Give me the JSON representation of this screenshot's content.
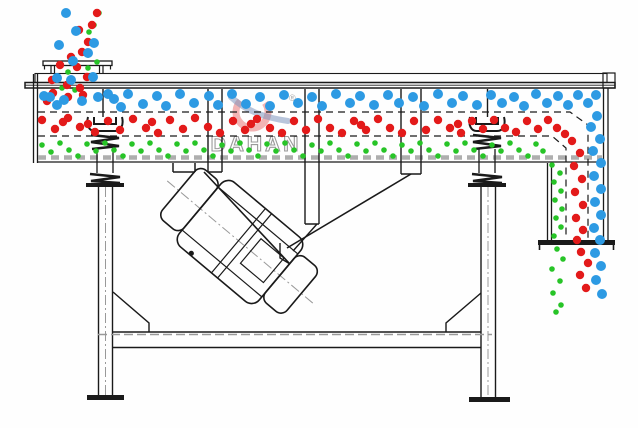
{
  "watermark": {
    "brand": "DAHAN",
    "registered": "®",
    "ring_color": "rgba(228,90,90,0.45)",
    "swoosh_color": "rgba(125,150,190,0.55)",
    "text_color": "#9a9a9a"
  },
  "colors": {
    "blue_particle": "#2d9ae3",
    "red_particle": "#e31a1a",
    "green_particle": "#27c427",
    "line": "#1a1a1a",
    "screen_dash": "#aeaeae",
    "background": "#fefefe"
  },
  "particles": {
    "blue": {
      "radius": 5,
      "color": "#2d9ae3",
      "points": [
        [
          66,
          13
        ],
        [
          76,
          31
        ],
        [
          59,
          45
        ],
        [
          94,
          43
        ],
        [
          88,
          53
        ],
        [
          73,
          61
        ],
        [
          57,
          78
        ],
        [
          71,
          80
        ],
        [
          93,
          77
        ],
        [
          50,
          97
        ],
        [
          64,
          100
        ],
        [
          82,
          101
        ],
        [
          98,
          97
        ],
        [
          108,
          94
        ],
        [
          44,
          96
        ],
        [
          57,
          105
        ],
        [
          114,
          99
        ],
        [
          121,
          107
        ],
        [
          128,
          94
        ],
        [
          143,
          104
        ],
        [
          157,
          96
        ],
        [
          166,
          106
        ],
        [
          180,
          94
        ],
        [
          194,
          103
        ],
        [
          209,
          96
        ],
        [
          218,
          105
        ],
        [
          232,
          94
        ],
        [
          246,
          104
        ],
        [
          260,
          97
        ],
        [
          270,
          106
        ],
        [
          284,
          95
        ],
        [
          298,
          103
        ],
        [
          312,
          97
        ],
        [
          322,
          106
        ],
        [
          336,
          94
        ],
        [
          350,
          103
        ],
        [
          360,
          96
        ],
        [
          374,
          105
        ],
        [
          388,
          95
        ],
        [
          399,
          103
        ],
        [
          413,
          97
        ],
        [
          424,
          106
        ],
        [
          438,
          94
        ],
        [
          452,
          103
        ],
        [
          463,
          96
        ],
        [
          477,
          105
        ],
        [
          491,
          95
        ],
        [
          502,
          103
        ],
        [
          514,
          97
        ],
        [
          524,
          106
        ],
        [
          536,
          94
        ],
        [
          547,
          103
        ],
        [
          558,
          96
        ],
        [
          568,
          105
        ],
        [
          578,
          95
        ],
        [
          588,
          103
        ],
        [
          596,
          95
        ],
        [
          597,
          116
        ],
        [
          591,
          127
        ],
        [
          600,
          139
        ],
        [
          593,
          151
        ],
        [
          601,
          163
        ],
        [
          594,
          176
        ],
        [
          601,
          189
        ],
        [
          595,
          202
        ],
        [
          601,
          215
        ],
        [
          594,
          228
        ],
        [
          600,
          240
        ],
        [
          595,
          253
        ],
        [
          601,
          266
        ],
        [
          596,
          280
        ],
        [
          602,
          294
        ]
      ]
    },
    "red": {
      "radius": 4.2,
      "color": "#e31a1a",
      "points": [
        [
          97,
          13
        ],
        [
          92,
          25
        ],
        [
          79,
          30
        ],
        [
          88,
          42
        ],
        [
          82,
          52
        ],
        [
          71,
          57
        ],
        [
          60,
          65
        ],
        [
          77,
          67
        ],
        [
          87,
          77
        ],
        [
          52,
          80
        ],
        [
          67,
          85
        ],
        [
          80,
          88
        ],
        [
          53,
          93
        ],
        [
          68,
          97
        ],
        [
          83,
          95
        ],
        [
          47,
          101
        ],
        [
          42,
          120
        ],
        [
          55,
          129
        ],
        [
          63,
          122
        ],
        [
          68,
          118
        ],
        [
          80,
          127
        ],
        [
          88,
          124
        ],
        [
          95,
          132
        ],
        [
          108,
          121
        ],
        [
          120,
          130
        ],
        [
          133,
          119
        ],
        [
          146,
          128
        ],
        [
          152,
          122
        ],
        [
          158,
          133
        ],
        [
          170,
          120
        ],
        [
          183,
          129
        ],
        [
          195,
          118
        ],
        [
          208,
          127
        ],
        [
          220,
          133
        ],
        [
          233,
          121
        ],
        [
          245,
          130
        ],
        [
          251,
          124
        ],
        [
          257,
          119
        ],
        [
          270,
          128
        ],
        [
          282,
          133
        ],
        [
          294,
          121
        ],
        [
          306,
          130
        ],
        [
          318,
          119
        ],
        [
          330,
          128
        ],
        [
          342,
          133
        ],
        [
          354,
          121
        ],
        [
          361,
          125
        ],
        [
          366,
          130
        ],
        [
          378,
          119
        ],
        [
          390,
          128
        ],
        [
          402,
          133
        ],
        [
          414,
          121
        ],
        [
          426,
          130
        ],
        [
          438,
          120
        ],
        [
          450,
          128
        ],
        [
          458,
          124
        ],
        [
          461,
          133
        ],
        [
          472,
          121
        ],
        [
          483,
          129
        ],
        [
          494,
          120
        ],
        [
          505,
          128
        ],
        [
          516,
          132
        ],
        [
          527,
          121
        ],
        [
          538,
          129
        ],
        [
          548,
          120
        ],
        [
          557,
          128
        ],
        [
          565,
          134
        ],
        [
          572,
          141
        ],
        [
          580,
          153
        ],
        [
          574,
          166
        ],
        [
          582,
          179
        ],
        [
          575,
          192
        ],
        [
          583,
          205
        ],
        [
          576,
          218
        ],
        [
          583,
          230
        ],
        [
          577,
          240
        ],
        [
          581,
          252
        ],
        [
          588,
          263
        ],
        [
          580,
          275
        ],
        [
          586,
          288
        ]
      ]
    },
    "green": {
      "radius": 2.8,
      "color": "#27c427",
      "points": [
        [
          99,
          13
        ],
        [
          94,
          25
        ],
        [
          89,
          32
        ],
        [
          95,
          43
        ],
        [
          88,
          55
        ],
        [
          97,
          62
        ],
        [
          68,
          72
        ],
        [
          88,
          68
        ],
        [
          62,
          88
        ],
        [
          75,
          90
        ],
        [
          42,
          145
        ],
        [
          51,
          152
        ],
        [
          60,
          143
        ],
        [
          69,
          150
        ],
        [
          78,
          156
        ],
        [
          87,
          144
        ],
        [
          96,
          151
        ],
        [
          105,
          143
        ],
        [
          114,
          150
        ],
        [
          123,
          156
        ],
        [
          132,
          144
        ],
        [
          141,
          151
        ],
        [
          150,
          143
        ],
        [
          159,
          150
        ],
        [
          168,
          156
        ],
        [
          177,
          144
        ],
        [
          186,
          151
        ],
        [
          195,
          143
        ],
        [
          204,
          150
        ],
        [
          213,
          156
        ],
        [
          222,
          145
        ],
        [
          231,
          151
        ],
        [
          240,
          143
        ],
        [
          249,
          150
        ],
        [
          258,
          156
        ],
        [
          267,
          144
        ],
        [
          276,
          151
        ],
        [
          285,
          143
        ],
        [
          294,
          150
        ],
        [
          303,
          156
        ],
        [
          312,
          145
        ],
        [
          321,
          151
        ],
        [
          330,
          143
        ],
        [
          339,
          150
        ],
        [
          348,
          156
        ],
        [
          357,
          144
        ],
        [
          366,
          151
        ],
        [
          375,
          143
        ],
        [
          384,
          150
        ],
        [
          393,
          156
        ],
        [
          402,
          145
        ],
        [
          411,
          151
        ],
        [
          420,
          143
        ],
        [
          429,
          150
        ],
        [
          438,
          156
        ],
        [
          447,
          144
        ],
        [
          456,
          151
        ],
        [
          465,
          143
        ],
        [
          474,
          150
        ],
        [
          483,
          156
        ],
        [
          492,
          145
        ],
        [
          501,
          151
        ],
        [
          510,
          143
        ],
        [
          519,
          150
        ],
        [
          528,
          156
        ],
        [
          536,
          144
        ],
        [
          543,
          151
        ],
        [
          552,
          165
        ],
        [
          560,
          173
        ],
        [
          554,
          182
        ],
        [
          561,
          191
        ],
        [
          555,
          200
        ],
        [
          562,
          209
        ],
        [
          556,
          218
        ],
        [
          561,
          227
        ],
        [
          554,
          236
        ],
        [
          557,
          249
        ],
        [
          563,
          259
        ],
        [
          552,
          269
        ],
        [
          560,
          281
        ],
        [
          553,
          293
        ],
        [
          561,
          305
        ],
        [
          556,
          312
        ]
      ]
    }
  }
}
